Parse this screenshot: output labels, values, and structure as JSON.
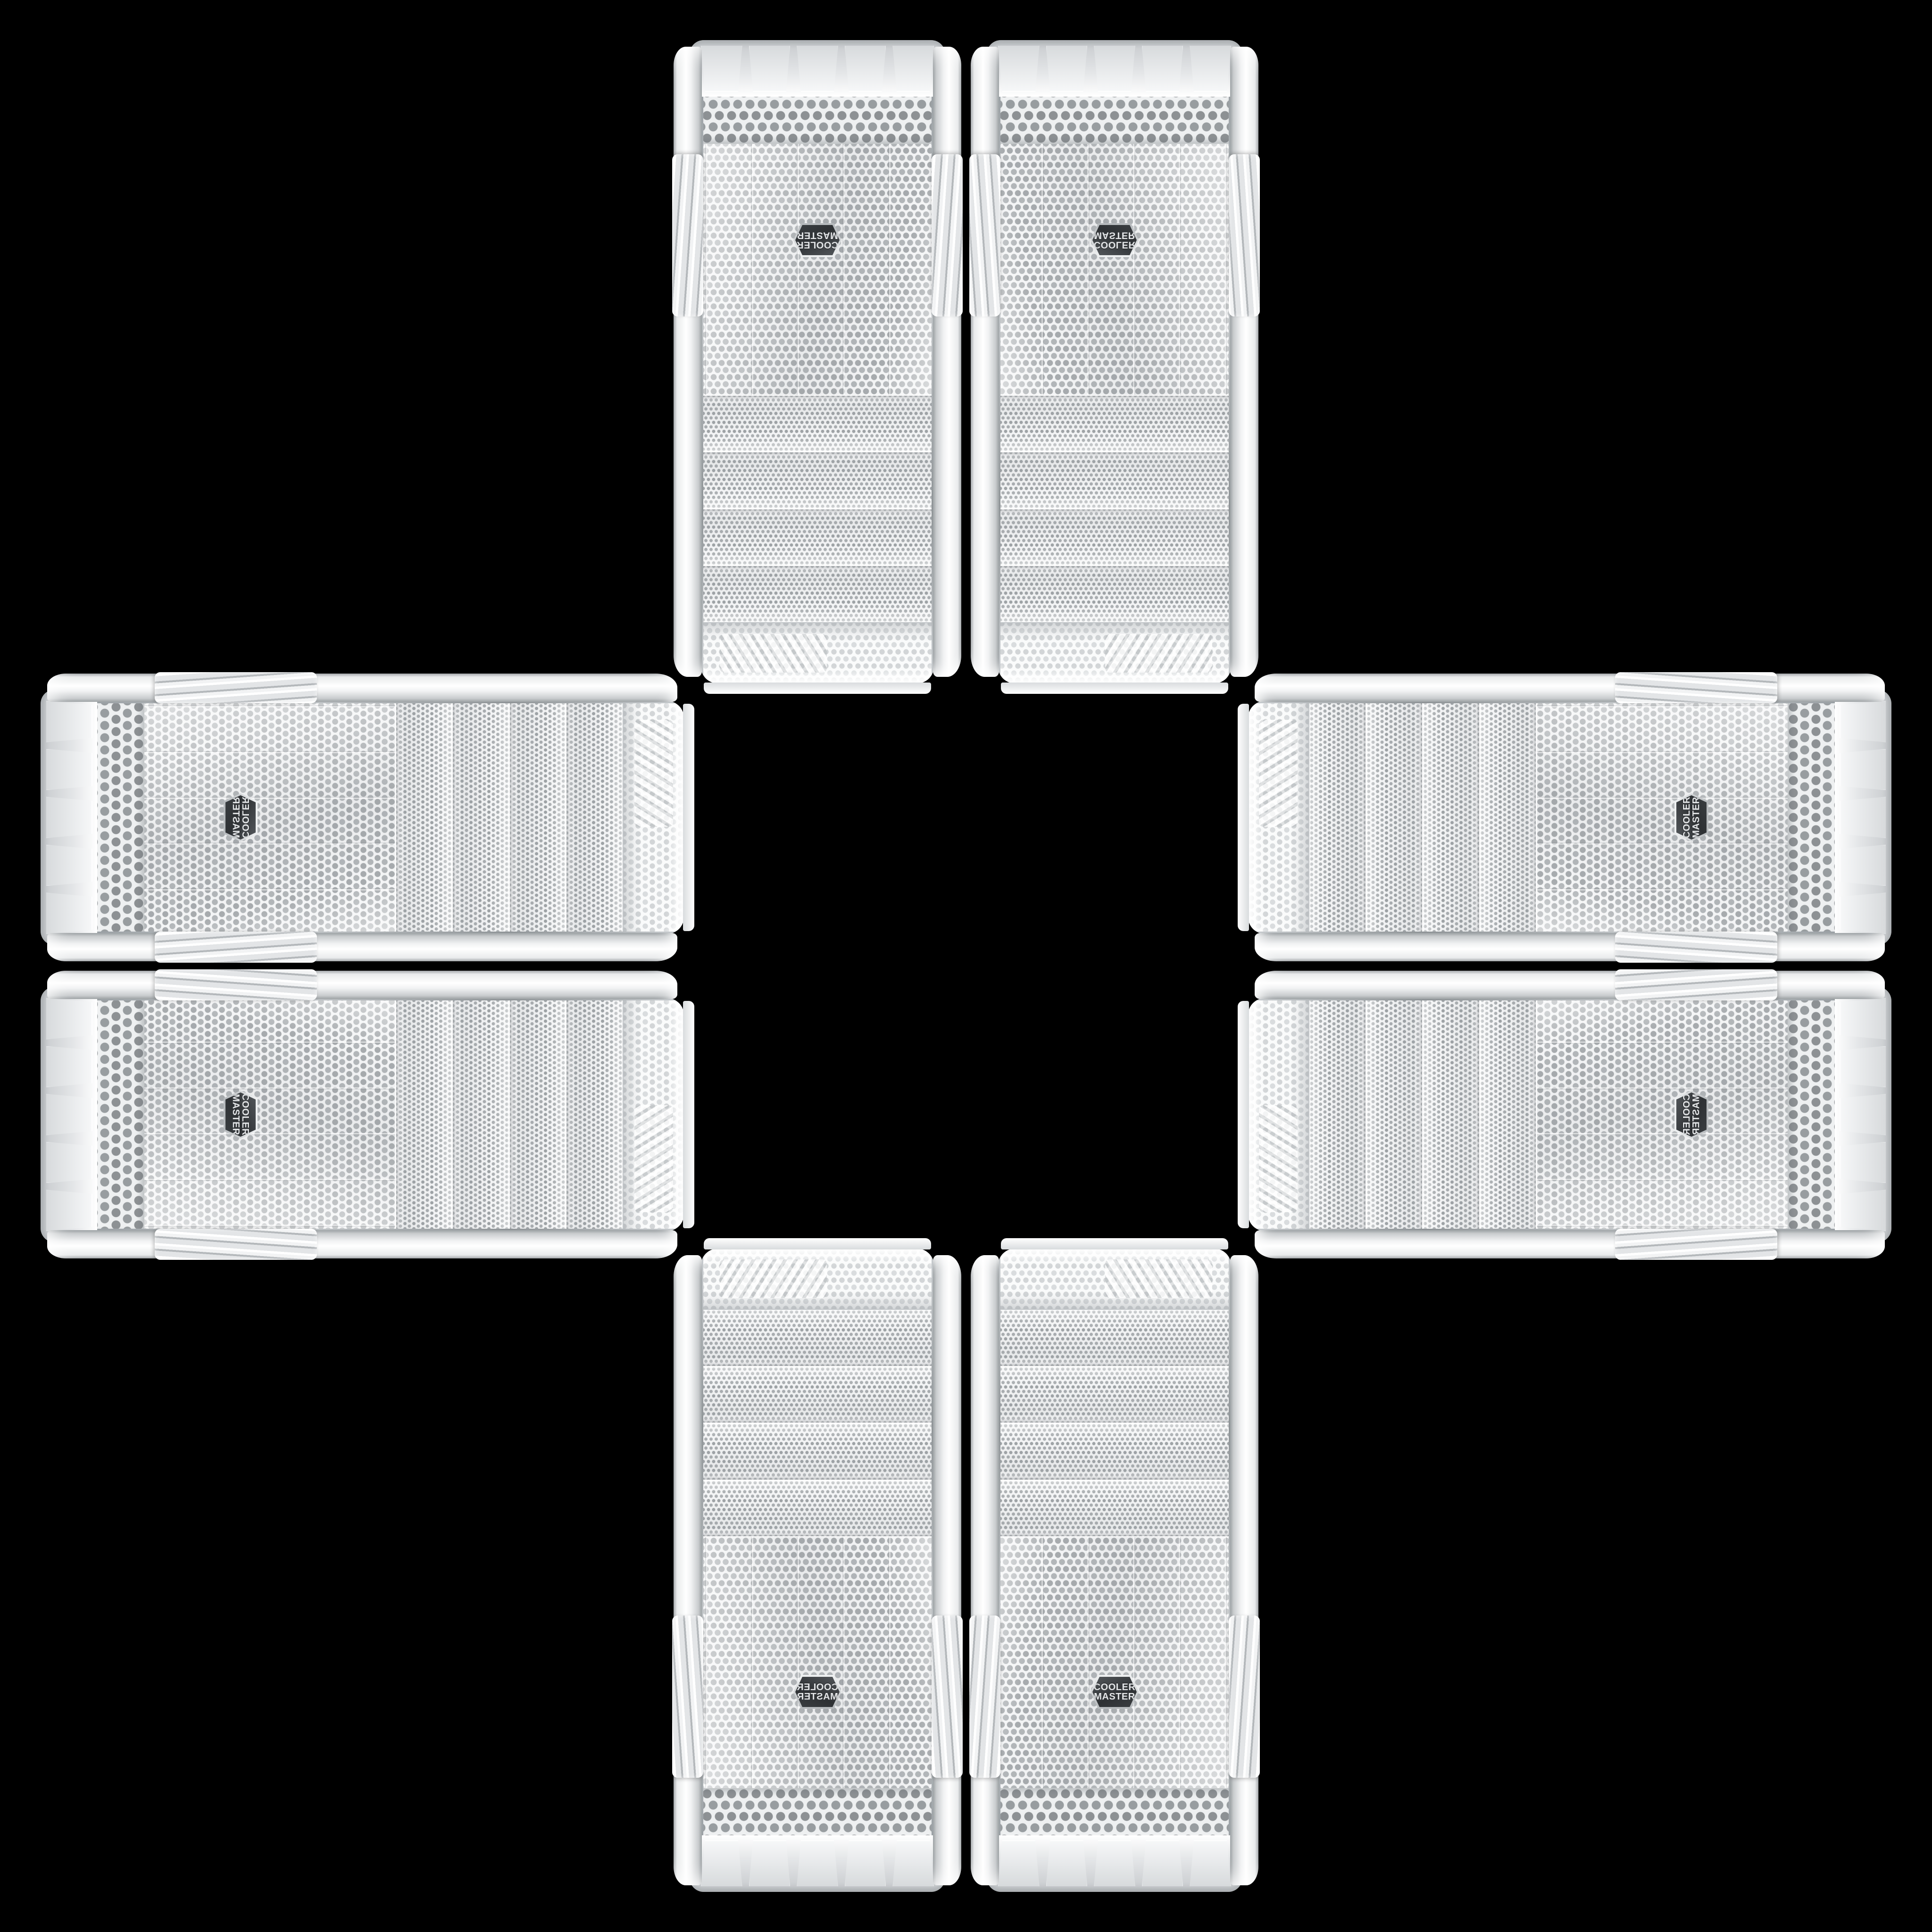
{
  "scene": {
    "subject": "Cooler Master white PC tower front panels",
    "background_color": "#000000",
    "panel_count": 8,
    "arrangement": "eight mirrored copies of one white case front panel forming a plus / cross collage",
    "center": "empty black square at the middle of the cross"
  },
  "logo": {
    "line1": "COOLER",
    "line2": "MASTER"
  },
  "badge": {
    "shape": "hexagonal shield",
    "background": "#33373a",
    "rim": "#cdd1d4",
    "text_color": "#e3e5e7"
  },
  "colors": {
    "bg": "#000000",
    "panel-white": "#f4f5f6",
    "rail-highlight": "#ffffff",
    "rail-shadow": "#9aa0a3",
    "mesh-dot": "#a7abae",
    "bay-dot": "#9ea3a6",
    "coarse-dot": "#8d9194",
    "seam-silver": "#9aa0a4"
  },
  "panel_features": {
    "crown": "bright curved perforated mesh top",
    "bay_strips": 4,
    "mesh_field": "fine perforated dot mesh with centered badge",
    "coarse_vent": "honeycomb vent strip",
    "feet_tabs": 5,
    "rail_ribs": "chevron grip grooves on both side rails"
  },
  "panels": [
    {
      "id": "top-left",
      "classes": "v pos-tl flip-both",
      "orientation": "rotated-180"
    },
    {
      "id": "top-right",
      "classes": "v pos-tr flip-y",
      "orientation": "flipped-vertical"
    },
    {
      "id": "left-top",
      "classes": "h pos-lt flip-y",
      "orientation": "rotated-90-flipped"
    },
    {
      "id": "right-top",
      "classes": "h pos-rt flip-both",
      "orientation": "rotated-270"
    },
    {
      "id": "left-bottom",
      "classes": "h pos-lb",
      "orientation": "rotated-90"
    },
    {
      "id": "right-bottom",
      "classes": "h pos-rb flip-x",
      "orientation": "rotated-90-mirrored"
    },
    {
      "id": "bottom-left",
      "classes": "v pos-bl flip-x",
      "orientation": "mirrored-horizontal"
    },
    {
      "id": "bottom-right",
      "classes": "v pos-br",
      "orientation": "upright"
    }
  ]
}
